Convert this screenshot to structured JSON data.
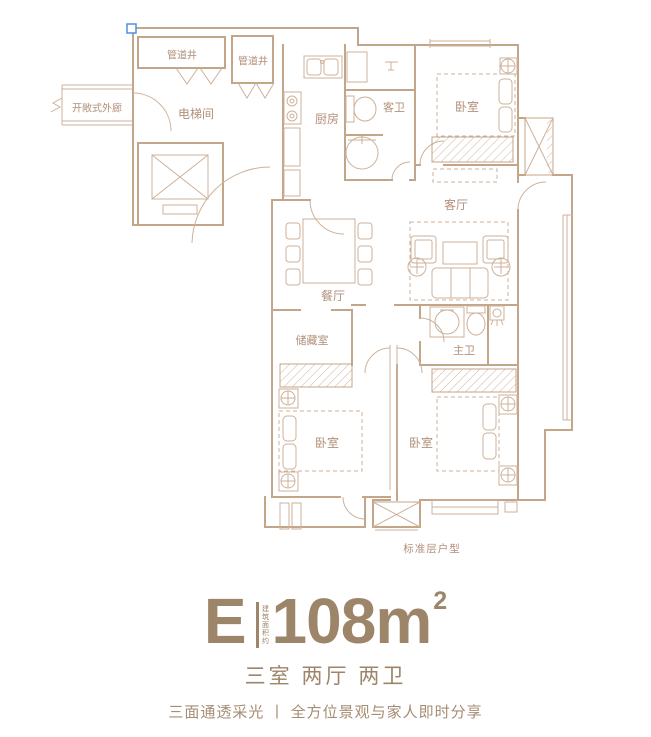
{
  "colors": {
    "wall": "#c3a58a",
    "thin": "#ccb199",
    "label": "#b1907a",
    "title": "#9c8568",
    "tagline": "#a58d74",
    "handle_blue": "#4d90e0"
  },
  "floorplan": {
    "caption": "标准层户型",
    "rooms": {
      "pipe_shaft_a": "管道井",
      "pipe_shaft_b": "管道井",
      "open_corridor": "开敞式外廊",
      "elevator_hall": "电梯间",
      "kitchen": "厨房",
      "guest_bath": "客卫",
      "bedroom_north": "卧室",
      "living_room": "客厅",
      "dining_room": "餐厅",
      "storage": "储藏室",
      "master_bath": "主卫",
      "bedroom_southwest": "卧室",
      "bedroom_south": "卧室"
    }
  },
  "info": {
    "unit_letter": "E",
    "area_note": "建筑面积约",
    "area_value": "108m",
    "area_sup": "2",
    "rooms_summary": "三室 两厅 两卫",
    "tagline": "三面通透采光 丨 全方位景观与家人即时分享"
  }
}
